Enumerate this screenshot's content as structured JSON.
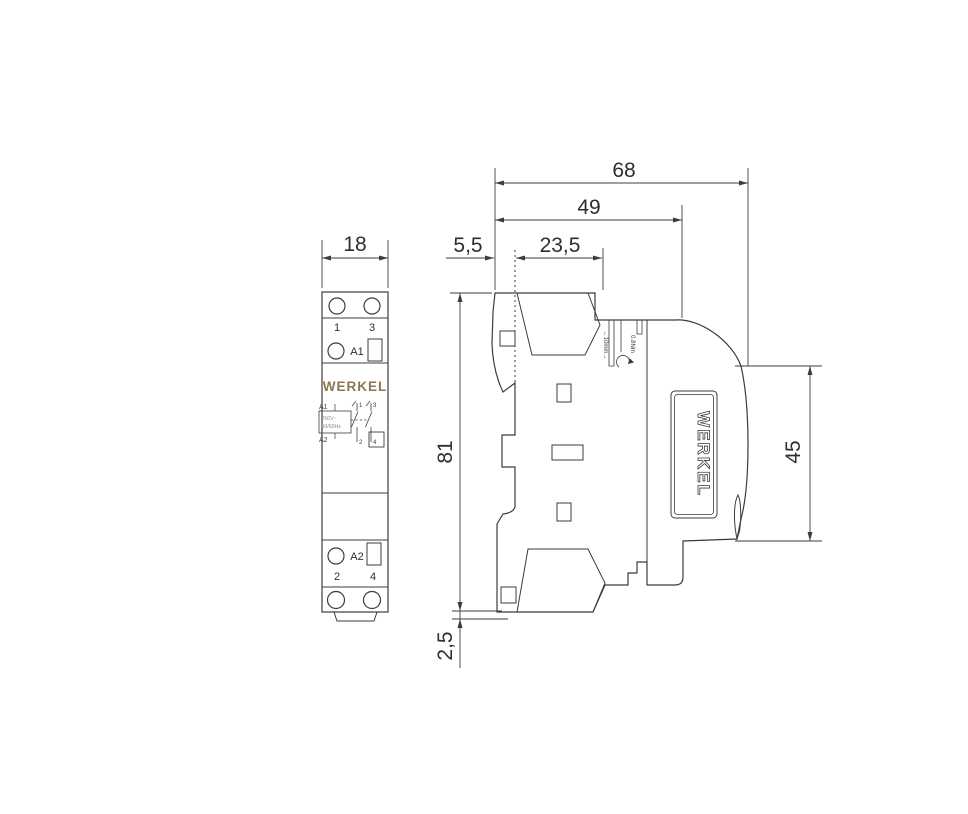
{
  "drawing_title": "Modular contactor dimensional drawing",
  "front": {
    "dim_width": "18",
    "labels": {
      "t1": "1",
      "t3": "3",
      "a1": "A1",
      "a2": "A2",
      "t2": "2",
      "t4": "4"
    },
    "brand": "WERKEL",
    "schematic": {
      "a1": "A1",
      "a2": "A2",
      "rating1": "250V~",
      "rating2": "50/60Hz",
      "c1": "1",
      "c3": "3",
      "c2": "2",
      "c4": "4"
    }
  },
  "side": {
    "dim_overall": "68",
    "dim_body": "49",
    "dim_front": "5,5",
    "dim_mid": "23,5",
    "dim_height": "81",
    "dim_step": "2,5",
    "dim_rail": "45",
    "strip": "←10mm→",
    "torque": "0.8Nm",
    "brand": "WERKEL"
  },
  "colors": {
    "line": "#3c3c3c",
    "brand_gold": "#8e7354"
  }
}
